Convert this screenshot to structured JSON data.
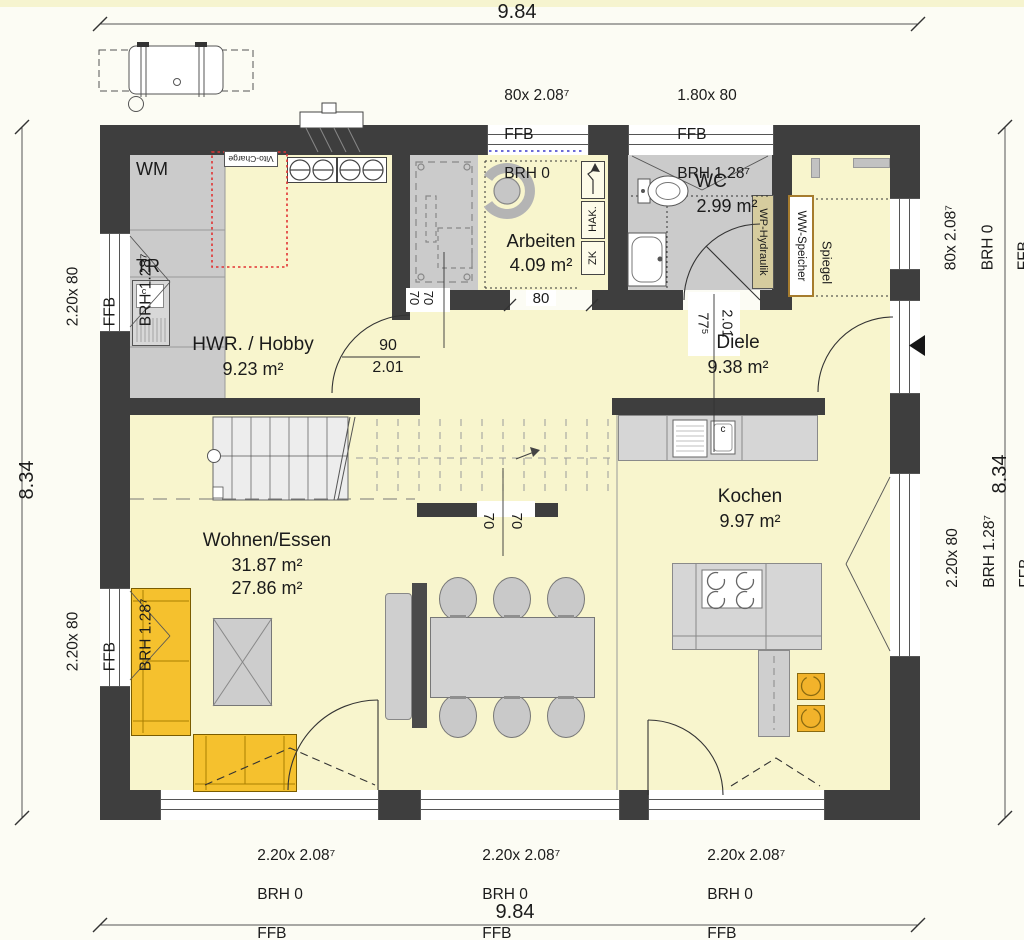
{
  "dimensions": {
    "top": "9.84",
    "bottom": "9.84",
    "left": "8.34",
    "right": "8.34"
  },
  "rooms": {
    "hwr": {
      "name": "HWR. / Hobby",
      "area": "9.23 m²"
    },
    "arbeiten": {
      "name": "Arbeiten",
      "area": "4.09 m²"
    },
    "wc": {
      "name": "WC",
      "area": "2.99 m²"
    },
    "diele": {
      "name": "Diele",
      "area": "9.38 m²"
    },
    "kochen": {
      "name": "Kochen",
      "area": "9.97 m²"
    },
    "wohnen": {
      "name": "Wohnen/Essen",
      "area_total": "31.87 m²",
      "area_living": "27.86 m²"
    }
  },
  "openings": {
    "top_door": {
      "size": "80x 2.08⁷",
      "line2": "FFB",
      "line3": "BRH 0"
    },
    "top_window": {
      "size": "1.80x 80",
      "line2": "FFB",
      "line3": "BRH 1.28⁷"
    },
    "right_top": {
      "size": "80x 2.08⁷",
      "line2": "BRH 0",
      "line3": "FFB"
    },
    "right_bottom": {
      "size": "2.20x 80",
      "line2": "BRH 1.28⁷",
      "line3": "FFB"
    },
    "left_top": {
      "size": "2.20x 80",
      "line2": "FFB",
      "line3": "BRH 1.28⁷"
    },
    "left_bottom": {
      "size": "2.20x 80",
      "line2": "FFB",
      "line3": "BRH 1.28⁷"
    },
    "bottom_left": {
      "size": "2.20x 2.08⁷",
      "line2": "BRH 0",
      "line3": "FFB"
    },
    "bottom_center": {
      "size": "2.20x 2.08⁷",
      "line2": "BRH 0",
      "line3": "FFB"
    },
    "bottom_right": {
      "size": "2.20x 2.08⁷",
      "line2": "BRH 0",
      "line3": "FFB"
    }
  },
  "doors": {
    "hwr_width": "90",
    "hwr_height": "2.01",
    "wc_width": "77⁵",
    "wc_height": "2.01",
    "arbeiten_width": "80",
    "stair_wall": {
      "a": "70",
      "b": "70"
    },
    "arbeiten_wall": {
      "a": "70",
      "b": "70"
    }
  },
  "labels": {
    "wm": "WM",
    "tr": "TR",
    "vito_charge": "Vito-Charge",
    "hak": "HAK.",
    "zk": "ZK",
    "wp_hydraulik": "WP-Hydraulik",
    "ww_speicher": "WW-Speicher",
    "spiegel": "Spiegel",
    "hwr_appliance": "c",
    "kitchen_appliance": "c"
  },
  "colors": {
    "wall": "#3e3e3e",
    "floor_living": "#f8f5cd",
    "floor_utility": "#cbcbcb",
    "furniture": "#d2d2d2",
    "sofa_yellow": "#f5c12e",
    "marker_red": "#e23333",
    "marker_blue": "#3a3acc"
  }
}
